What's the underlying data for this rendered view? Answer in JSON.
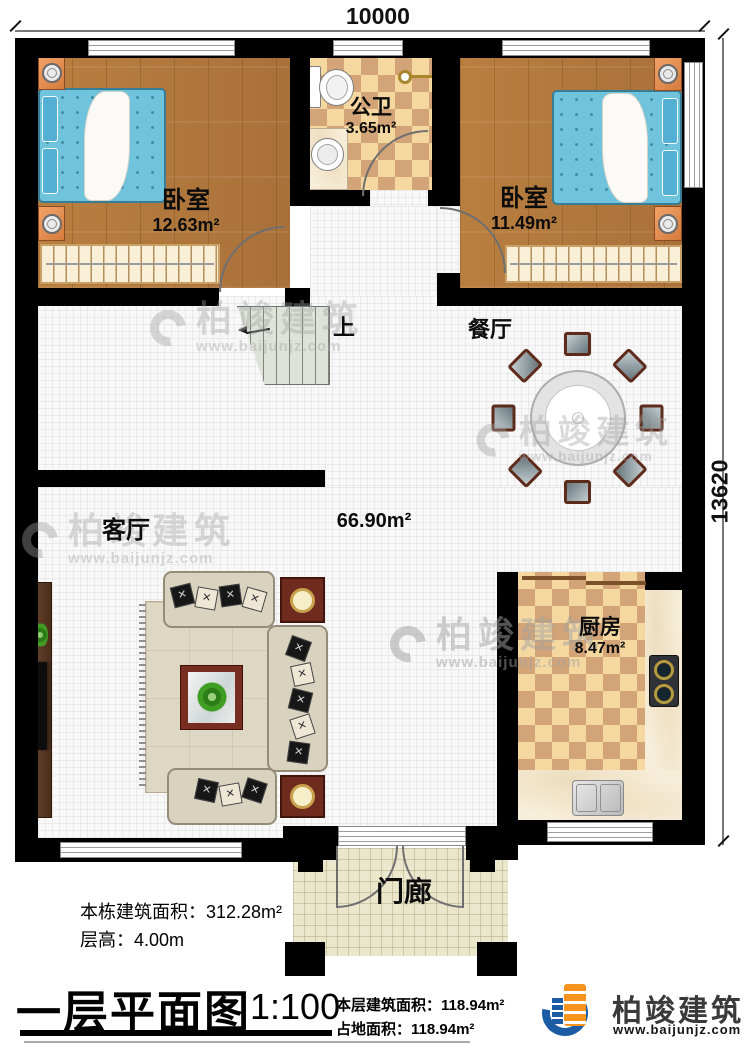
{
  "watermark": {
    "name": "柏竣建筑",
    "website": "www.baijunjz.com"
  },
  "dimensions": {
    "width_mm": "10000",
    "height_mm": "13620"
  },
  "rooms": {
    "bedroom_left": {
      "name": "卧室",
      "area": "12.63m²"
    },
    "bathroom": {
      "name": "公卫",
      "area": "3.65m²"
    },
    "bedroom_right": {
      "name": "卧室",
      "area": "11.49m²"
    },
    "dining": {
      "name": "餐厅"
    },
    "living": {
      "name": "客厅"
    },
    "open_area": {
      "area": "66.90m²"
    },
    "kitchen": {
      "name": "厨房",
      "area": "8.47m²"
    },
    "porch": {
      "name": "门廊"
    },
    "stairs": {
      "direction": "上"
    }
  },
  "annotations": {
    "building_area_label": "本栋建筑面积：",
    "building_area_value": "312.28m²",
    "floor_height_label": "层高：",
    "floor_height_value": "4.00m"
  },
  "titleblock": {
    "title": "一层平面图",
    "scale": "1:100",
    "floor_area_label": "本层建筑面积：",
    "floor_area_value": "118.94m²",
    "footprint_label": "占地面积：",
    "footprint_value": "118.94m²"
  },
  "brand": {
    "name": "柏竣建筑",
    "website": "www.baijunjz.com"
  }
}
